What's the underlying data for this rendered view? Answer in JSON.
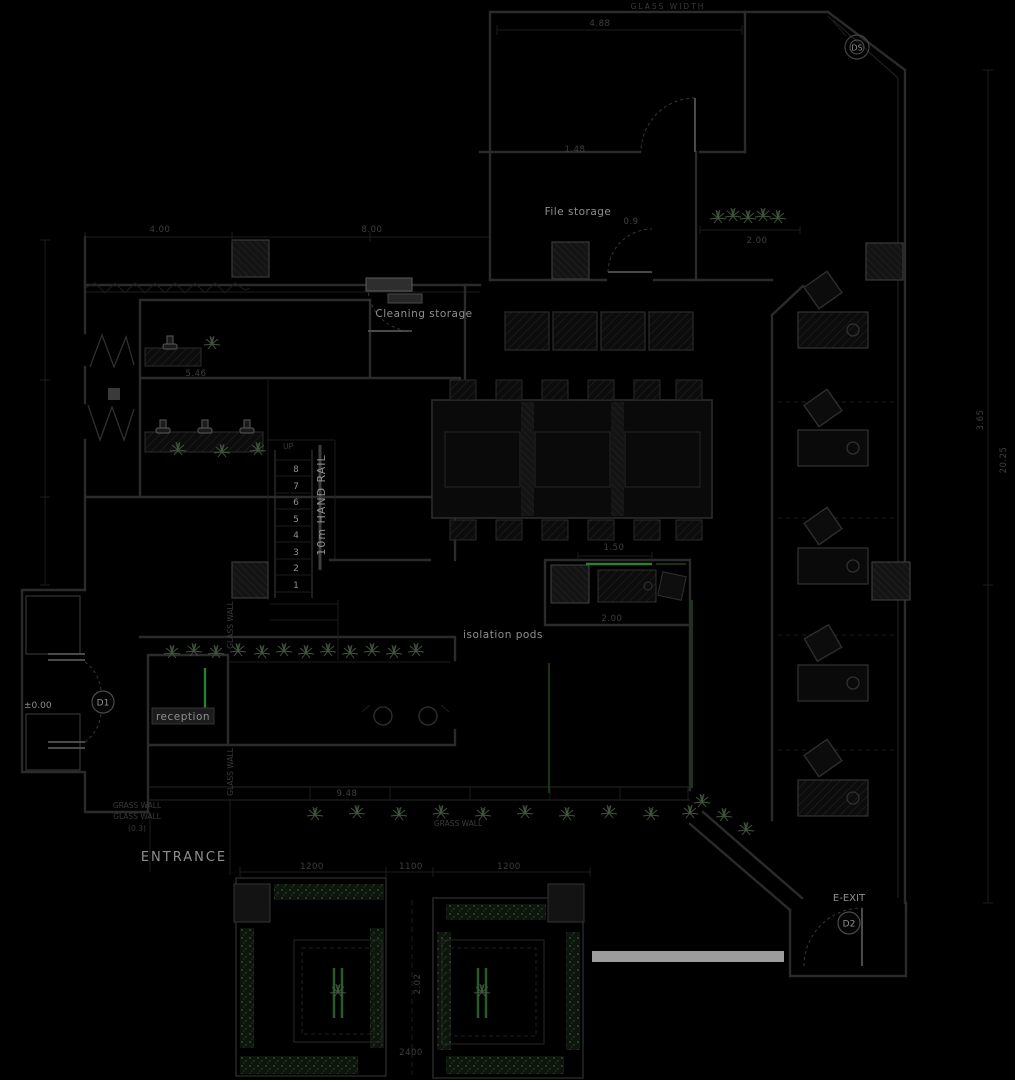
{
  "title": "Office floor plan (dark CAD view)",
  "colors": {
    "background": "#000000",
    "wall": "#2b2b2b",
    "label_text": "#8f8f8f",
    "dim_text": "#3f3f3f",
    "green_accent": "#2e7d32",
    "plant_green": "#42543f",
    "ramp_gray": "#9c9c9c"
  },
  "rooms": {
    "file_storage": "File storage",
    "cleaning_storage": "Cleaning storage",
    "isolation_pods": "isolation pods",
    "reception": "reception",
    "entrance": "ENTRANCE",
    "e_exit": "E-EXIT"
  },
  "annotations": {
    "glass_width": "GLASS WIDTH",
    "hand_rail": "10m HAND RAIL",
    "up": "UP",
    "grass_wall": "GRASS WALL",
    "glass_wall": "GLASS WALL",
    "wall_thickness": "(0.3)",
    "grass_wall_right": "GRASS WALL",
    "glass_wall_side_upper": "GLASS WALL",
    "glass_wall_side_lower": "GLASS WALL",
    "level_mark": "±0.00"
  },
  "doors": {
    "d1": "D1",
    "d2": "D2",
    "ds": "DS"
  },
  "dimensions": {
    "top_span": "4.88",
    "top_inner": "1.48",
    "plant_row": "2.00",
    "file_door": "0.9",
    "sink_counter": "5.46",
    "left_a": "4.00",
    "left_b": "8.00",
    "pods_top": "1.50",
    "pods_bottom": "2.00",
    "walkway": "9.48",
    "court_a": "1200",
    "court_mid": "1100",
    "court_b": "1200",
    "court_gap": "2.02",
    "court_bottom": "2400",
    "right_upper": "3.65",
    "right_lower": "20.25"
  },
  "stairs": {
    "numbers": [
      "8",
      "7",
      "6",
      "5",
      "4",
      "3",
      "2",
      "1"
    ]
  }
}
